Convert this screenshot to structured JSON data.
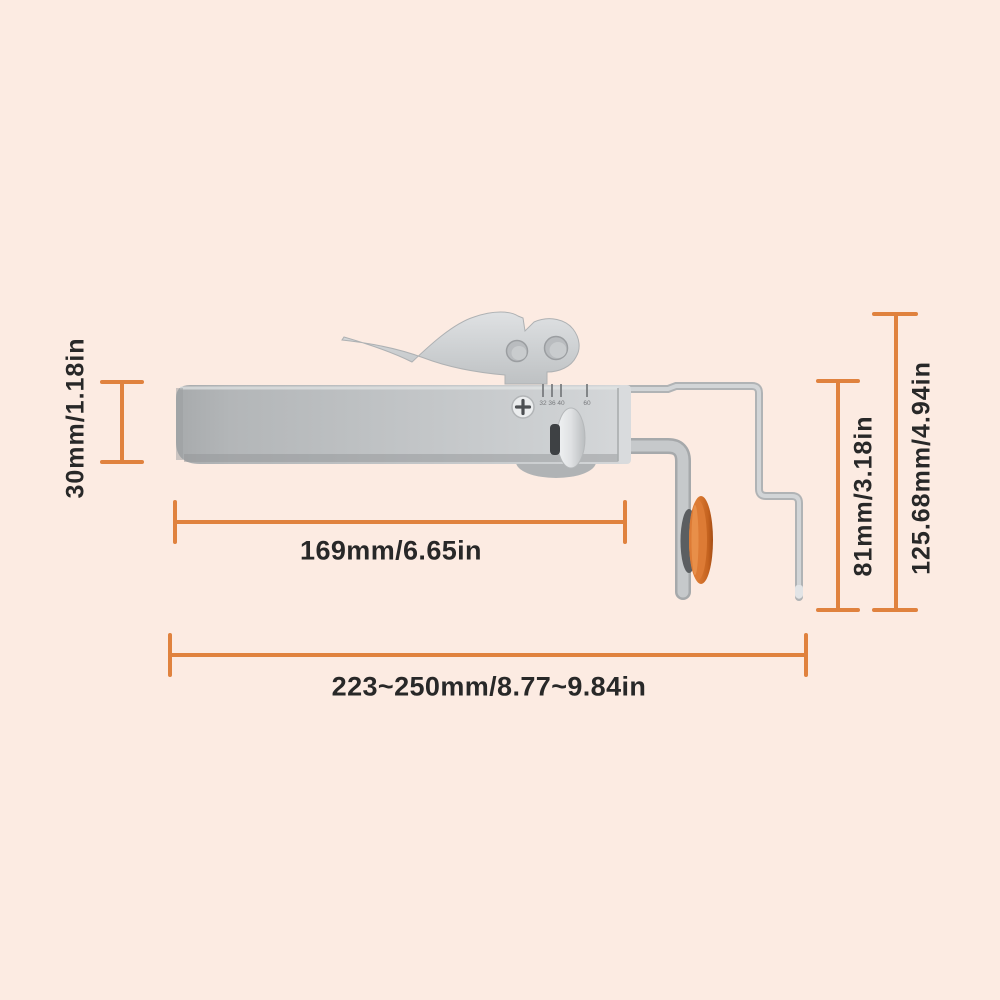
{
  "canvas": {
    "background": "#fcebe2"
  },
  "colors": {
    "dimension_line": "#e0823e",
    "label_text": "#282828",
    "cutting_wheel_orange": "#dd7b35",
    "tool_metal_gray": "#c3c6c8"
  },
  "dimensions": {
    "body_height": "30mm/1.18in",
    "body_length": "169mm/6.65in",
    "total_length": "223~250mm/8.77~9.84in",
    "bracket_height": "81mm/3.18in",
    "total_height": "125.68mm/4.94in"
  },
  "tool": {
    "scale_marks": "32 36 40",
    "scale_mark_end": "60"
  }
}
